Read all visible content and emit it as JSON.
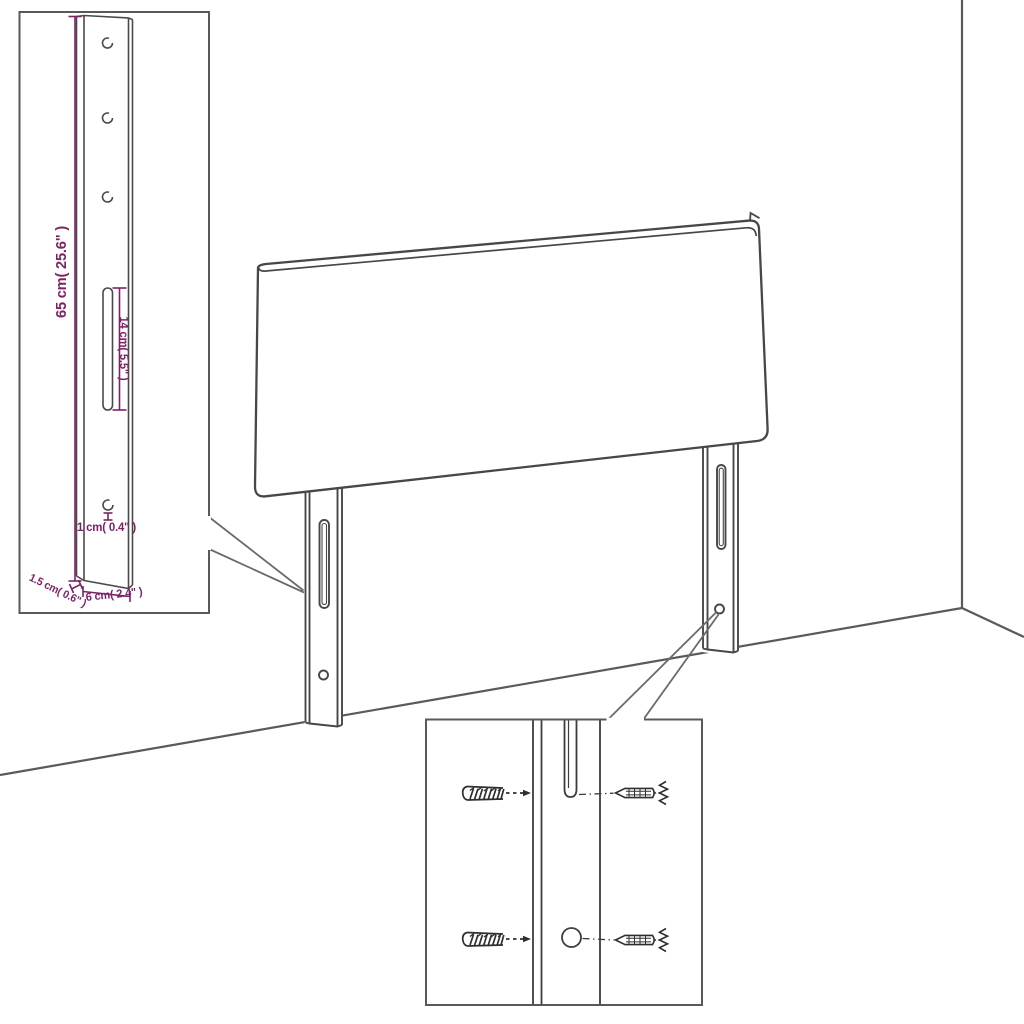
{
  "scene": {
    "subject": "headboard-assembly-diagram",
    "environment": "room-corner",
    "description": "Upholstered headboard with two slotted mounting legs shown against a wall corner, with an enlarged dimensioned leg callout and a wall-plug/screw mounting detail callout"
  },
  "colors": {
    "background": "#ffffff",
    "line": "#474747",
    "box_border": "#595959",
    "dimension": "#7d2266"
  },
  "leg_detail_callout": {
    "height_label": "65 cm( 25.6\" )",
    "slot_label": "14 cm( 5.5\" )",
    "hole_label": "1 cm( 0.4\" )",
    "thickness_label": "1.5 cm( 0.6\" )",
    "width_label": "6 cm( 2.4\" )",
    "top_hole_count": 3
  },
  "mounting_detail_callout": {
    "wall_anchor_count": 2,
    "screw_count": 2,
    "fastener_rows": 2
  }
}
